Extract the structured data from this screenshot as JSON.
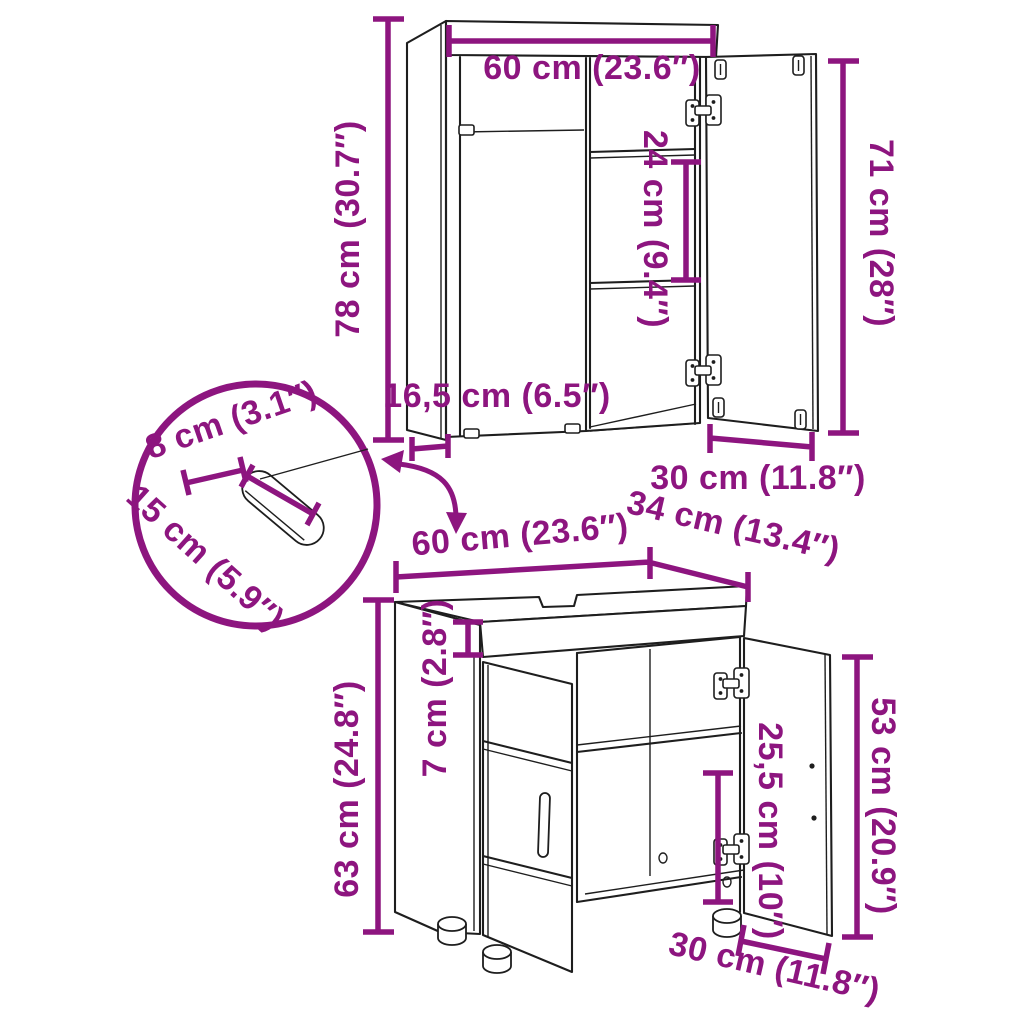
{
  "diagram_type": "furniture-dimension-diagram",
  "product": "2-piece bathroom furniture set (mirror cabinet and sink cabinet)",
  "colors": {
    "accent": "#8D157F",
    "line": "#1E1E1E",
    "background": "#FFFFFF"
  },
  "top_cabinet": {
    "width": "60 cm (23.6″)",
    "height": "78 cm (30.7″)",
    "shelf_spacing": "24 cm (9.4″)",
    "door_height": "71 cm (28″)",
    "depth": "16,5 cm (6.5″)",
    "door_width": "30 cm (11.8″)"
  },
  "detail_view": {
    "cutout_width": "8 cm (3.1″)",
    "cutout_length": "15 cm (5.9″)"
  },
  "bottom_cabinet": {
    "width": "60 cm (23.6″)",
    "depth": "34 cm (13.4″)",
    "apron_height": "7 cm (2.8″)",
    "height": "63 cm (24.8″)",
    "door_height": "53 cm (20.9″)",
    "interior_height": "25,5 cm (10″)",
    "door_width": "30 cm (11.8″)"
  }
}
